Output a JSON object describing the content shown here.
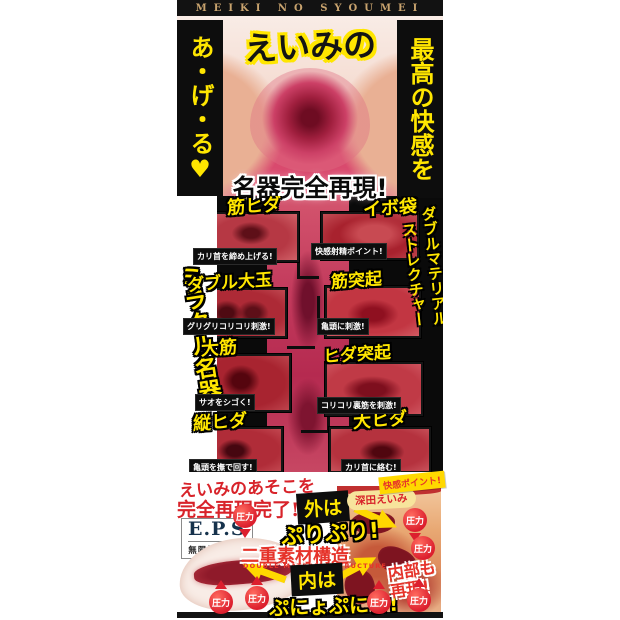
{
  "banner": {
    "text": "MEIKI NO SYOUMEI"
  },
  "hero": {
    "title": "えいみの",
    "left_vertical": "あ・げ・る♥",
    "right_vertical": "最高の快感を",
    "headline": "名器完全再現!"
  },
  "panel": {
    "left_vertical": "ミラクル名器",
    "right_vertical_outer": "ダブルマテリアル",
    "right_vertical_inner": "ストレクチャー",
    "callouts": [
      {
        "label": "筋ヒダ",
        "caption": "カリ首を締め上げる!"
      },
      {
        "label": "イボ袋",
        "caption": "快感射精ポイント!"
      },
      {
        "label": "ダブル大玉",
        "caption": "グリグリコリコリ刺激!"
      },
      {
        "label": "筋突起",
        "caption": "亀頭に刺激!"
      },
      {
        "label": "大筋",
        "caption": "サオをシゴく!"
      },
      {
        "label": "ヒダ突起",
        "caption": "コリコリ裏筋を刺激!"
      },
      {
        "label": "縦ヒダ",
        "caption": "亀頭を撫で回す!"
      },
      {
        "label": "大ヒダ",
        "caption": "カリ首に絡む!"
      }
    ]
  },
  "bottom": {
    "recreate_line1": "えいみのあそこを",
    "recreate_line2": "完全再現完了!",
    "eps_logo": "E.P.S",
    "eps_sub": "無限快感構造",
    "outer_label": "外は",
    "outer_value": "ぷりぷり!",
    "structure_jp": "二重素材構造",
    "structure_en": "DOUBLE MATERIAL STRUCTURE",
    "inner_label": "内は",
    "inner_value": "ぷにょぷにょ!",
    "inside_line1": "内部も",
    "inside_line2": "再現!",
    "model_name": "深田えいみ",
    "point_badge": "快感ポイント!",
    "pressure": "圧力"
  },
  "colors": {
    "accent_yellow": "#ffe600",
    "accent_red": "#e6332a",
    "banner_gold": "#c8a36e",
    "panel_black": "#0a0a0a"
  }
}
